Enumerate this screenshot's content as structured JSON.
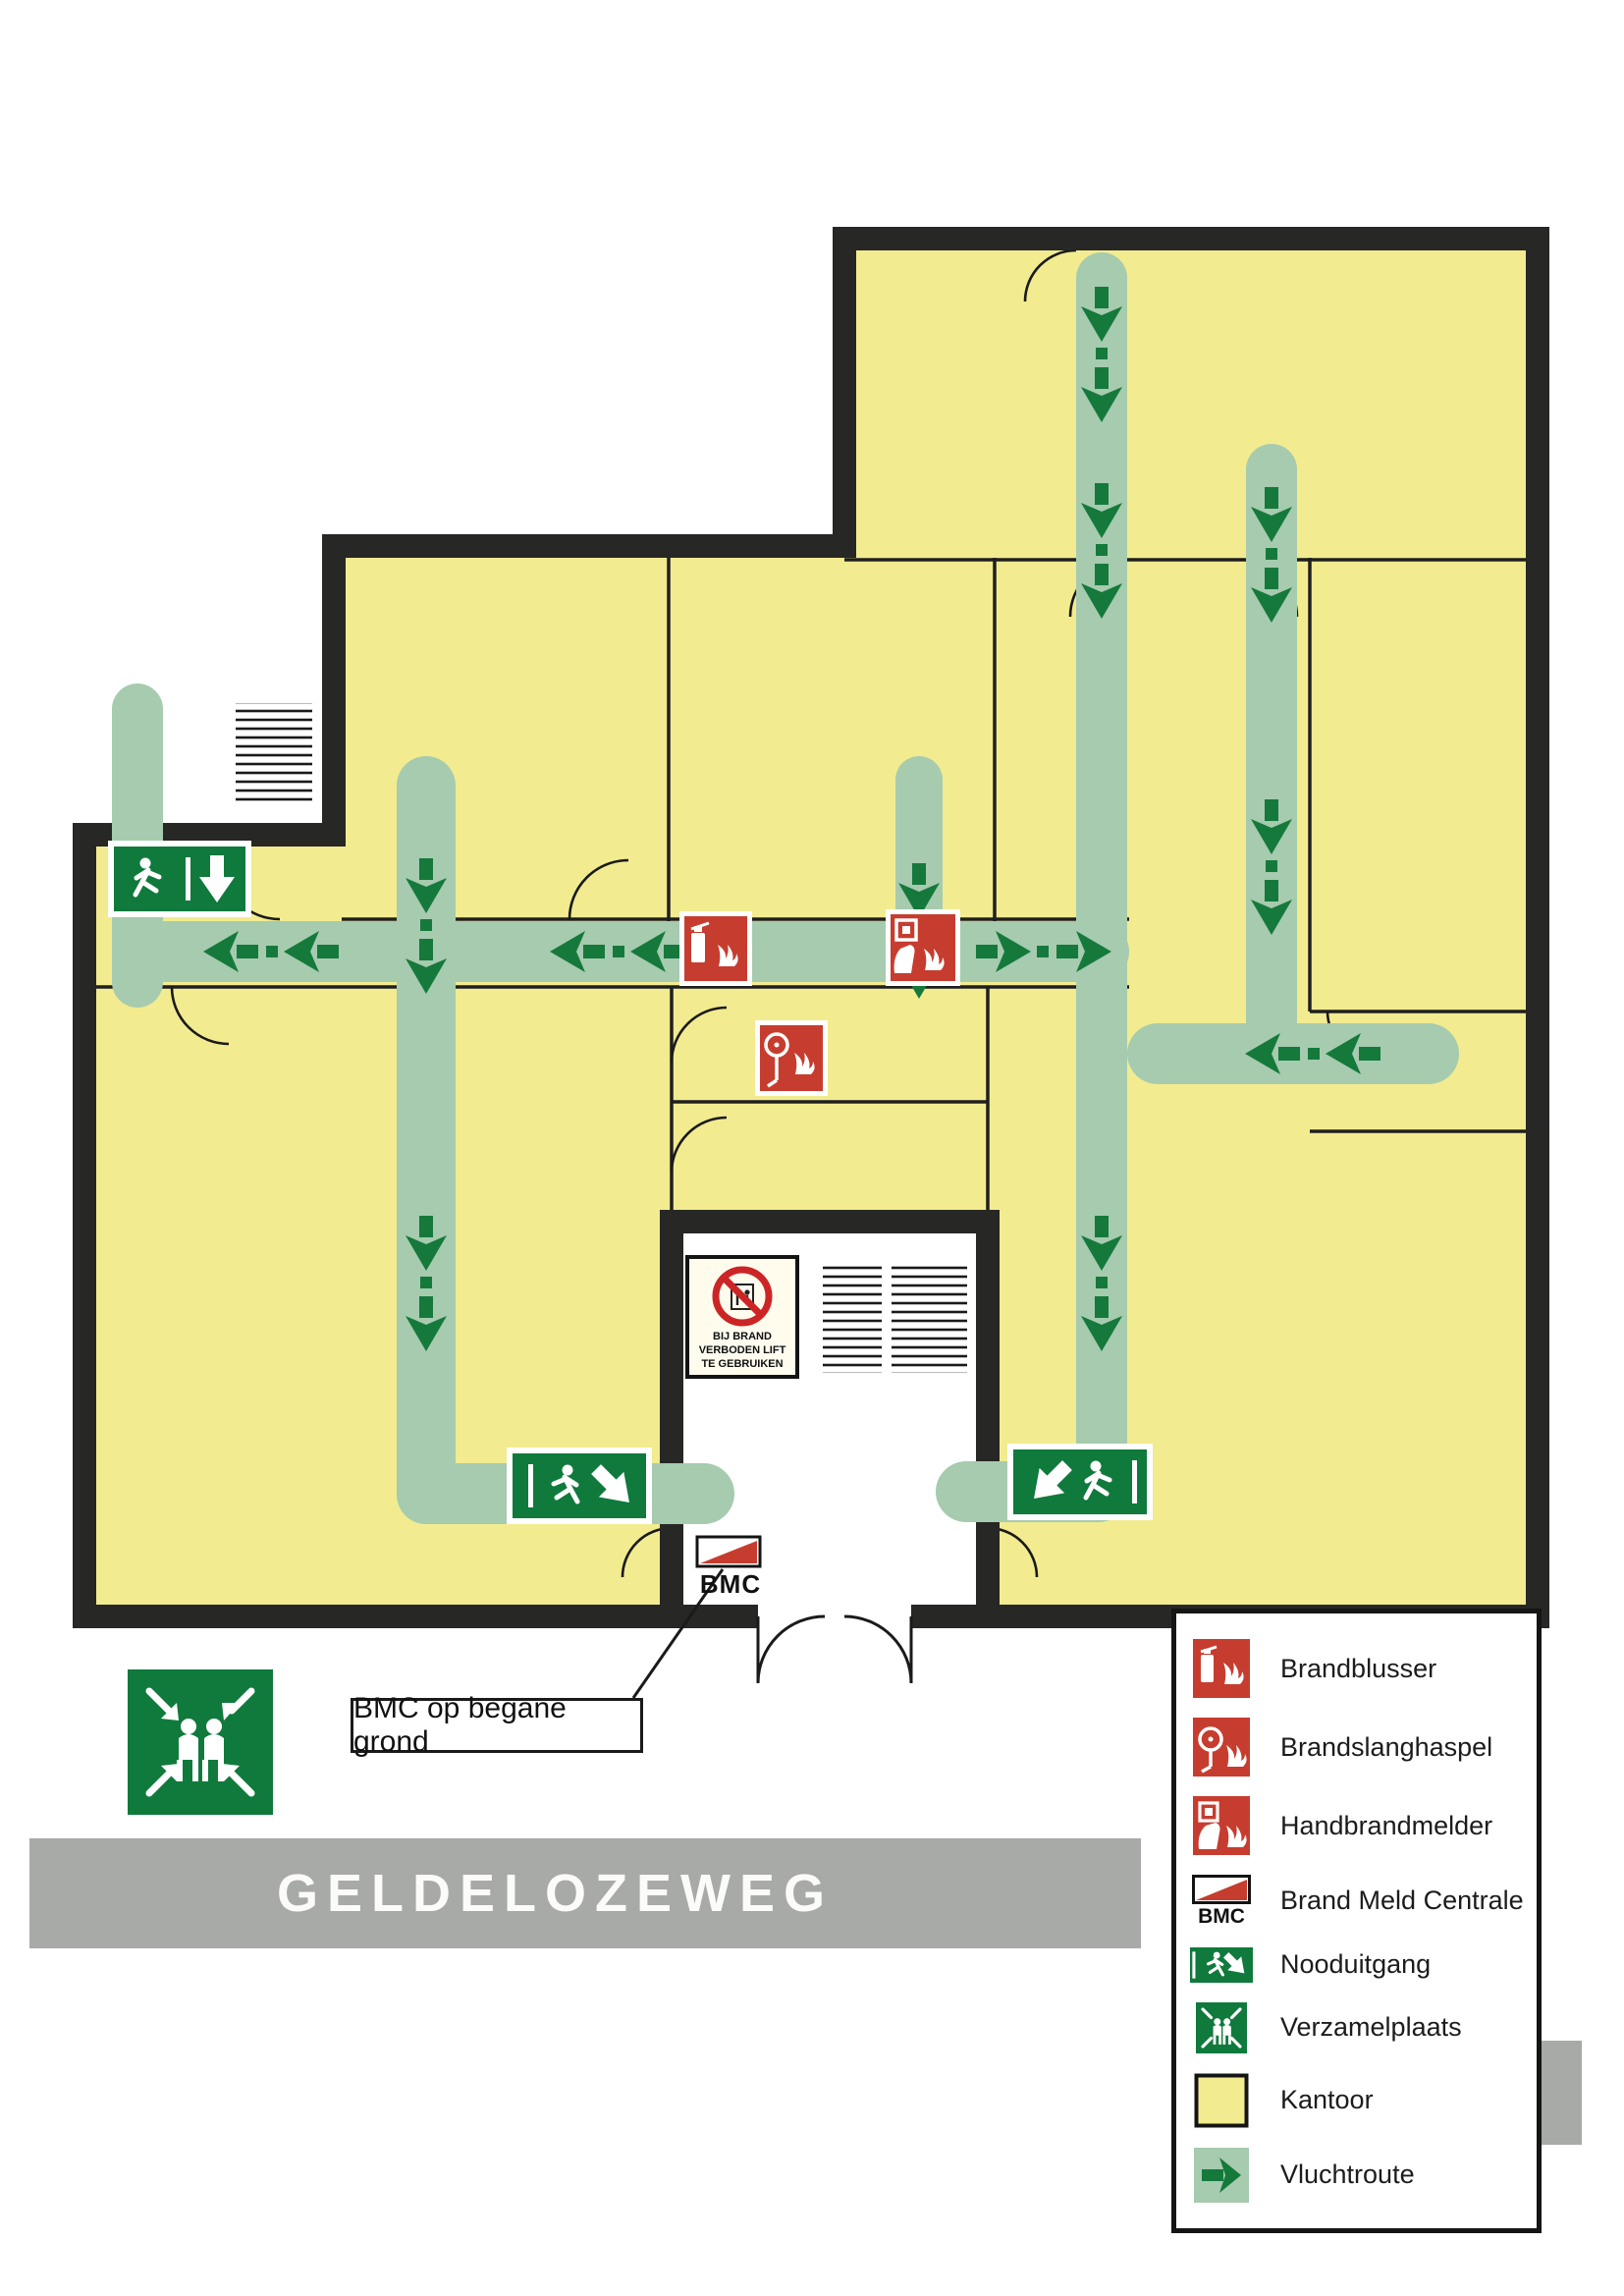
{
  "plan": {
    "street_label": "GELDELOZEWEG",
    "bmc_label": "BMC",
    "bmc_callout": "BMC op begane grond",
    "lift_sign_lines": [
      "BIJ BRAND",
      "VERBODEN LIFT",
      "TE GEBRUIKEN"
    ]
  },
  "legend": {
    "items": [
      {
        "label": "Brandblusser",
        "icon": "fire-extinguisher-sign"
      },
      {
        "label": "Brandslanghaspel",
        "icon": "fire-hose-reel-sign"
      },
      {
        "label": "Handbrandmelder",
        "icon": "manual-call-point-sign"
      },
      {
        "label": "Brand Meld Centrale",
        "icon": "bmc-sign",
        "sublabel": "BMC"
      },
      {
        "label": "Nooduitgang",
        "icon": "emergency-exit-sign"
      },
      {
        "label": "Verzamelplaats",
        "icon": "assembly-point-sign"
      },
      {
        "label": "Kantoor",
        "icon": "office-swatch"
      },
      {
        "label": "Vluchtroute",
        "icon": "escape-route-swatch"
      }
    ]
  },
  "colors": {
    "office_yellow": "#f2eb90",
    "route_green": "#a6cbaf",
    "arrow_green": "#15793b",
    "sign_green": "#0f7a3c",
    "sign_red": "#c63d2f",
    "wall_black": "#272725",
    "banner_gray": "#a8aaa7"
  }
}
